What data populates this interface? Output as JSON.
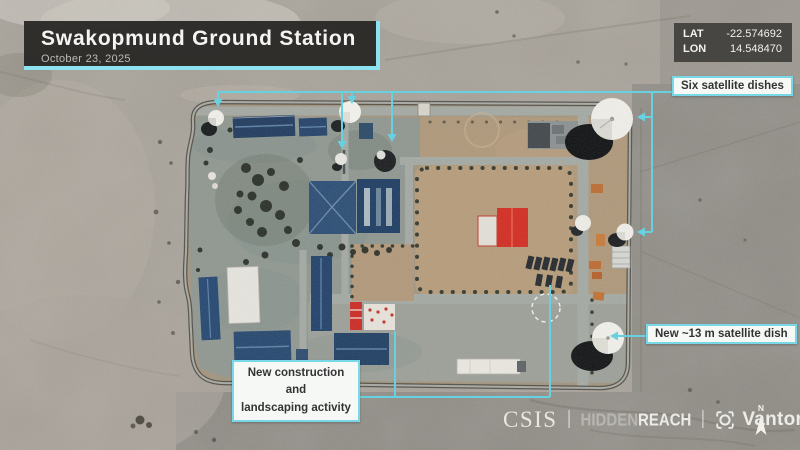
{
  "header": {
    "title": "Swakopmund Ground Station",
    "date": "October 23, 2025"
  },
  "coordinates": {
    "lat_label": "LAT",
    "lat_value": "-22.574692",
    "lon_label": "LON",
    "lon_value": "14.548470"
  },
  "annotations": {
    "six_dishes": {
      "label": "Six satellite dishes"
    },
    "new_dish": {
      "label": "New ~13 m satellite dish"
    },
    "construction": {
      "line1": "New construction and",
      "line2": "landscaping activity"
    }
  },
  "footer": {
    "csis": "CSIS",
    "separator": "|",
    "hiddenreach": {
      "hidden": "HIDDEN",
      "reach": "REACH"
    },
    "vantor": "Vantor",
    "north": "N"
  },
  "colors": {
    "annotation_cyan": "#67d1e2",
    "label_border_cyan": "#79d8e7",
    "title_border_cyan": "#8ce2f0",
    "label_bg": "#f6f8f6",
    "title_bg": "#2a2927",
    "blue_roof": "#22426a",
    "red_roof": "#d32b20",
    "desert_light": "#aba59a",
    "desert_dark": "#8f8c85",
    "compound_dirt": "#b0987a"
  }
}
